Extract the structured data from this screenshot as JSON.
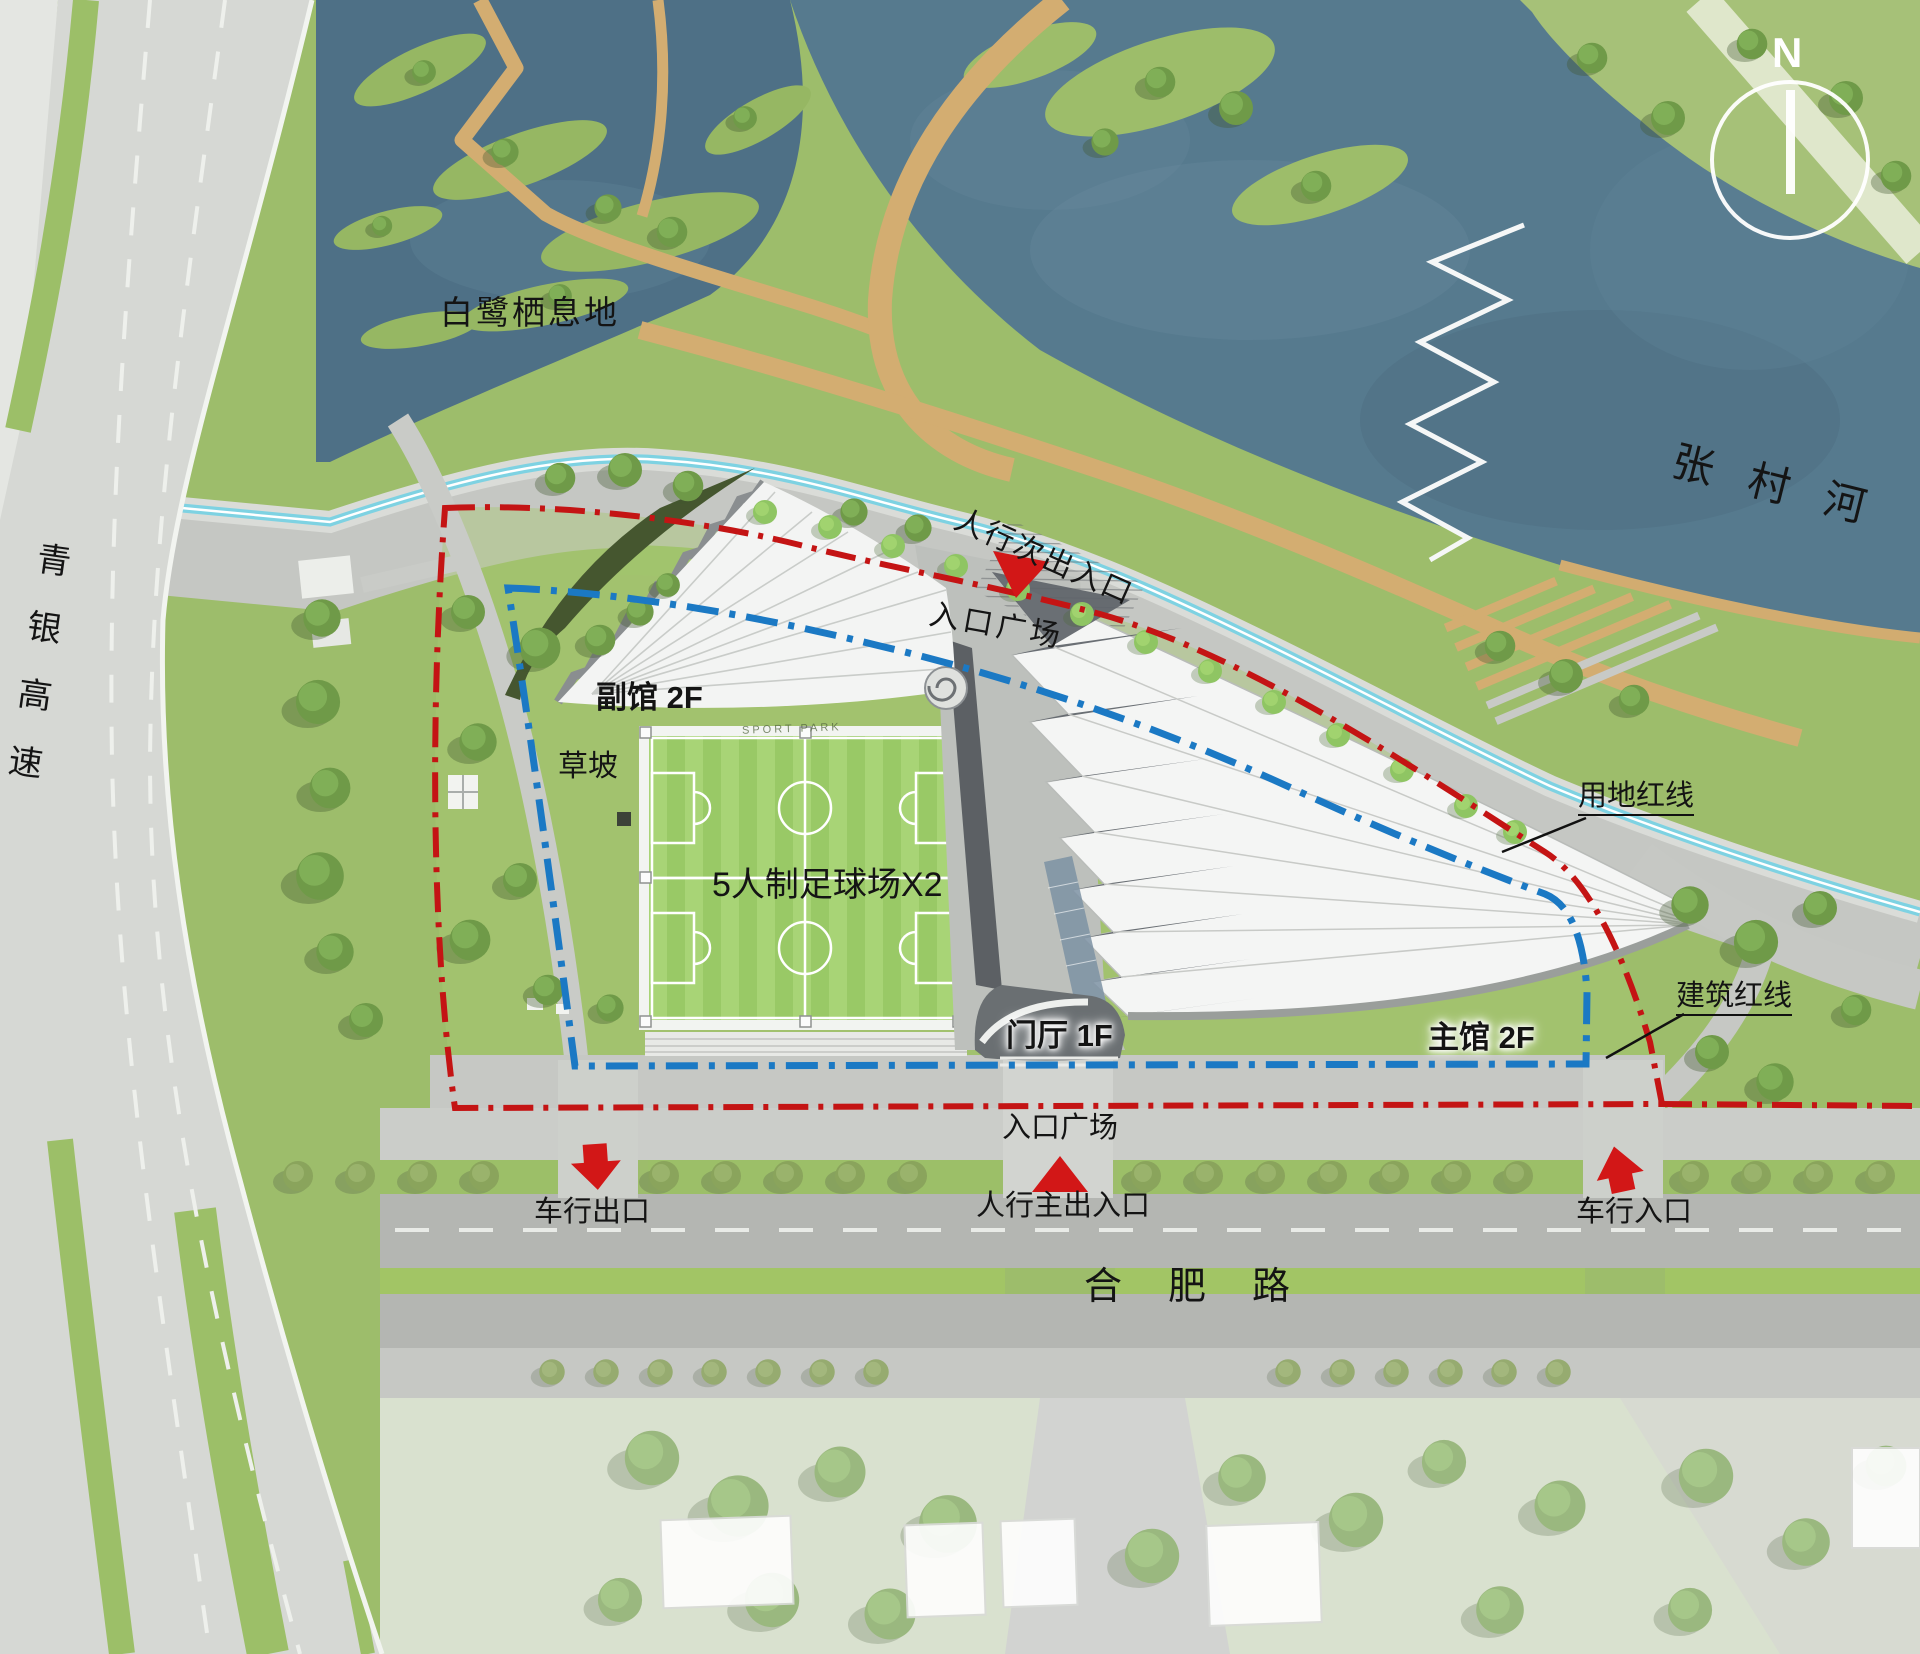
{
  "context": {
    "habitat": "白鹭栖息地",
    "river": "张村河",
    "expressway": "青银高速",
    "south_road": "合肥路",
    "north": "N",
    "sport_park": "SPORT PARK"
  },
  "site": {
    "annex": "副馆  2F",
    "main_hall": "主馆  2F",
    "lobby": "门厅 1F",
    "field": "5人制足球场X2",
    "grass_slope": "草坡",
    "plaza_north": "入口广场",
    "plaza_south": "入口广场"
  },
  "entrances": {
    "pedestrian_secondary": "人行次出入口",
    "pedestrian_main": "人行主出入口",
    "vehicle_exit": "车行出口",
    "vehicle_entrance": "车行入口"
  },
  "boundaries": {
    "site_boundary": "用地红线",
    "building_boundary": "建筑红线"
  },
  "colors": {
    "site_boundary": "#c41414",
    "building_boundary": "#1b79c4",
    "marker_red": "#d21717",
    "greenway": "#7ed2e2",
    "water": "#567a8e",
    "boardwalk": "#d3ad71"
  }
}
